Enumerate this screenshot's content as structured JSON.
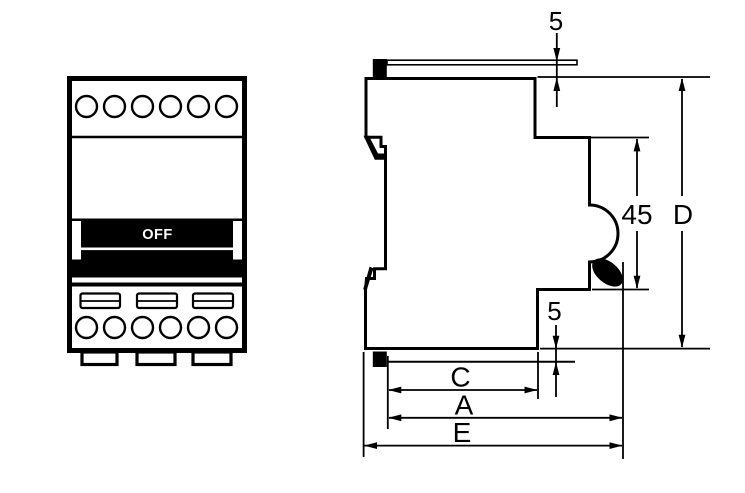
{
  "front_view": {
    "switch_label": "OFF"
  },
  "side_view": {
    "dims": {
      "top_offset": "5",
      "handle_height": "45",
      "total_height": "D",
      "bottom_offset": "5",
      "depth_c": "C",
      "depth_a": "A",
      "depth_e": "E"
    }
  },
  "colors": {
    "line": "#000000",
    "background": "#ffffff",
    "switch_text": "#ffffff"
  }
}
